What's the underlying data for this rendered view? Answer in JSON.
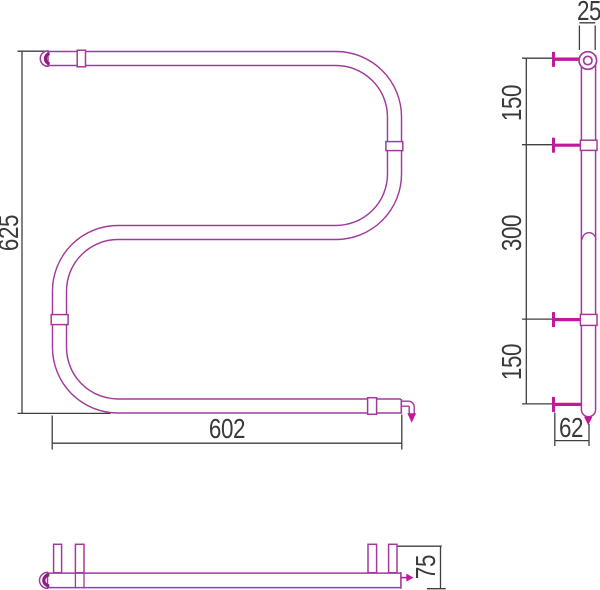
{
  "drawing": {
    "dimensions": {
      "height_total": "625",
      "width_total": "602",
      "pipe_diameter": "25",
      "spacing_top": "150",
      "spacing_middle": "300",
      "spacing_bottom": "150",
      "wall_offset": "62",
      "depth": "75"
    },
    "colors": {
      "pipe_outline": "#A23A9C",
      "accent_bold": "#C2189C",
      "cap_accent": "#8E1C82",
      "dimension_lines": "#3F3F3F"
    }
  }
}
